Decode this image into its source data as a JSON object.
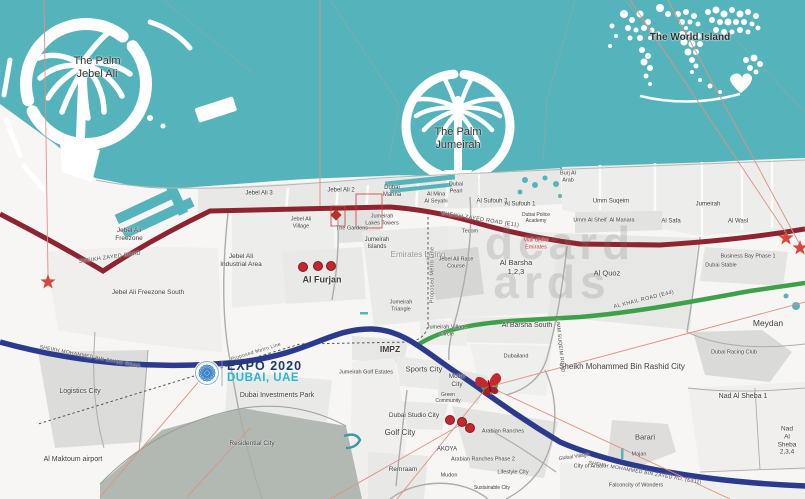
{
  "map": {
    "labels": {
      "palm_jebel_ali": "The Palm\nJebel Ali",
      "palm_jumeirah": "The Palm\nJumeirah",
      "world_island": "The World Island",
      "jebel_ali_3": "Jebel Ali 3",
      "jebel_ali_2": "Jebel Ali 2",
      "dubai_marina": "Dubai\nMarina",
      "al_mina_al_seyahi": "Al Mina\nAl Seyahi",
      "dubai_pearl": "Dubai\nPearl",
      "burj_al_arab": "Burj Al\nArab",
      "al_sufouh_2": "Al Sufouh 2",
      "al_sufouh_1": "Al Sufouh 1",
      "dubai_police_academy": "Dubai Police\nAcademy",
      "umm_suqeim": "Umm Suqeim",
      "umm_al_sheif": "Umm Al Sheif",
      "al_manara": "Al Manara",
      "jumeirah": "Jumeirah",
      "al_safa": "Al Safa",
      "al_wasl": "Al Wasl",
      "jumeirah_lakes_towers": "Jumeirah\nLakes Towers",
      "jebel_ali_village": "Jebel Ali\nVillage",
      "the_gardens": "The Gardens",
      "jumeirah_islands": "Jumeirah\nIslands",
      "emirates_living": "Emirates Living",
      "jebel_ali_race_course": "Jebel Ali Race\nCourse",
      "tecom": "Tecom",
      "mall_of_the_emirates": "Mall of the\nEmirates",
      "al_barsha": "Al Barsha\n1,2,3",
      "al_quoz": "Al Quoz",
      "business_bay_phase_1": "Business Bay Phase 1",
      "dubai_stable": "Dubai Stable",
      "meydan": "Meydan",
      "dubai_racing_club": "Dubai Racing Club",
      "nad_al_sheba_1": "Nad Al Sheba 1",
      "nad_al_sheba_234": "Nad Al Sheba\n2,3,4",
      "barari": "Barari",
      "majan": "Majan",
      "city_of_arabia": "City of Arabia",
      "falconcity": "Falconcity of Wonders",
      "global_village": "Global Village",
      "smbr_city": "Sheikh Mohammed Bin Rashid City",
      "al_barsha_south": "Al Barsha South",
      "dubailand": "Dubailand",
      "jumeirah_triangle": "Jumeirah\nTriangle",
      "jumeirah_village_circle": "Jumeirah Village\nCircle",
      "impz": "IMPZ",
      "sports_city": "Sports City",
      "motor_city": "Motor\nCity",
      "green_community": "Green\nCommunity",
      "jumeirah_golf_estates": "Jumeirah Golf Estates",
      "dubai_studio_city": "Dubai Studio City",
      "golf_city": "Golf City",
      "akoya": "AKOYA",
      "remraam": "Remraam",
      "mudon": "Mudon",
      "arabian_ranches": "Arabian Ranches",
      "arabian_ranches_2": "Arabian Ranches Phase 2",
      "lifestyle_city": "Lifestyle City",
      "sustainable_city": "Sustainable City",
      "logistics_city": "Logistics City",
      "al_maktoum_airport": "Al Maktoum airport",
      "dubai_investments_park": "Dubai  Investments Park",
      "residential_city": "Residential City",
      "jebel_ali_freezone": "Jebel Ali\nFreezone",
      "jebel_ali_freezone_south": "Jebel Ali Freezone South",
      "jebel_ali_industrial": "Jebel Ali\nIndustrial Area",
      "al_furjan": "Al Furjan"
    },
    "road_labels": {
      "szr_left": "SHEIKH ZAYED ROAD",
      "szr_e11": "SHEIKH ZAYED ROAD (E11)",
      "smbz_left": "SHEIKH MOHAMMED BIN ZAYED ROAD",
      "smbz_e311": "SHEIKH MOHAMMED BIN ZAYED RD.  (E311)",
      "al_khail": "AL KHAIL ROAD  (E44)",
      "umm_suqeim_road": "UMM SUQEIM ROAD",
      "metro_vertical": "Proposed Metro Line",
      "metro_diagonal": "Proposed Metro Line"
    },
    "expo": {
      "line1": "EXPO 2020",
      "line2": "DUBAI, UAE"
    },
    "watermark": {
      "line1": "dcard",
      "line2": "ards"
    },
    "colors": {
      "sea": "#55b4bb",
      "road_red": "#8e2430",
      "road_blue": "#2c3a8e",
      "road_green": "#3fa04b",
      "marker_red": "#c6262e",
      "star_red": "#d8453a",
      "expo_navy": "#1d3a66",
      "expo_cyan": "#29b5d6"
    }
  }
}
